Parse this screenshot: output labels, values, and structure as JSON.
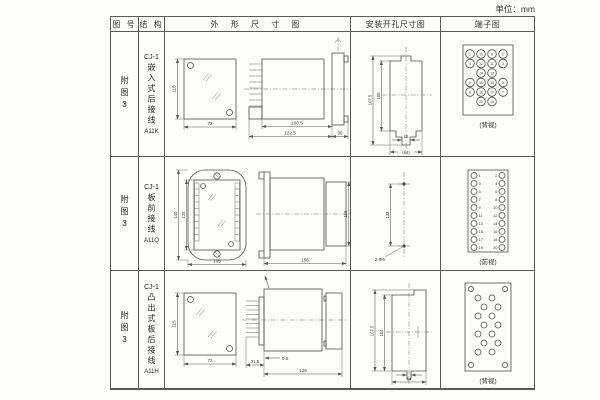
{
  "page": {
    "unit_label": "单位：mm"
  },
  "headers": {
    "fig_no": "图 号",
    "structure": "结 构",
    "outline": "外 形 尺 寸 图",
    "install": "安装开孔尺寸图",
    "terminal": "端子图"
  },
  "rows": [
    {
      "fig_no": "附图3",
      "model": "CJ-1",
      "structure": "嵌入式后接线",
      "code": "A11K",
      "outline": {
        "h": "115",
        "w": "72",
        "d1": "100.5",
        "d2": "122.5",
        "d3": "35"
      },
      "install": {
        "h1": "107.5",
        "h2": "105",
        "slot": "16",
        "w": "(64)"
      },
      "terminal": {
        "view": "(背视)",
        "n": [
          "2",
          "10",
          "9",
          "1",
          "4",
          "12",
          "11",
          "3",
          "14",
          "13",
          "6",
          "16",
          "15",
          "5",
          "8",
          "18",
          "17",
          "7",
          "20",
          "19"
        ]
      }
    },
    {
      "fig_no": "附图3",
      "model": "CJ-1",
      "structure": "板前接线",
      "code": "A11Q",
      "outline": {
        "h1": "140",
        "h2": "125",
        "w": "105",
        "l": "156",
        "h3": "115"
      },
      "install": {
        "h": "133",
        "holes": "2-Φ6"
      },
      "terminal": {
        "view": "(前视)",
        "left": [
          "1",
          "3",
          "5",
          "7",
          "9",
          "11",
          "13",
          "15",
          "17",
          "19"
        ],
        "right": [
          "2",
          "4",
          "6",
          "8",
          "10",
          "12",
          "14",
          "16",
          "18",
          "20"
        ]
      }
    },
    {
      "fig_no": "附图3",
      "model": "CJ-1",
      "structure": "凸出式板后接线",
      "code": "A11H",
      "outline": {
        "h": "115",
        "w": "72",
        "d1": "31.5",
        "d2": "9.5",
        "d3": "126"
      },
      "install": {
        "h1": "107.5",
        "h2": "104",
        "w": "64"
      },
      "terminal": {
        "view": "(背视)"
      }
    }
  ]
}
